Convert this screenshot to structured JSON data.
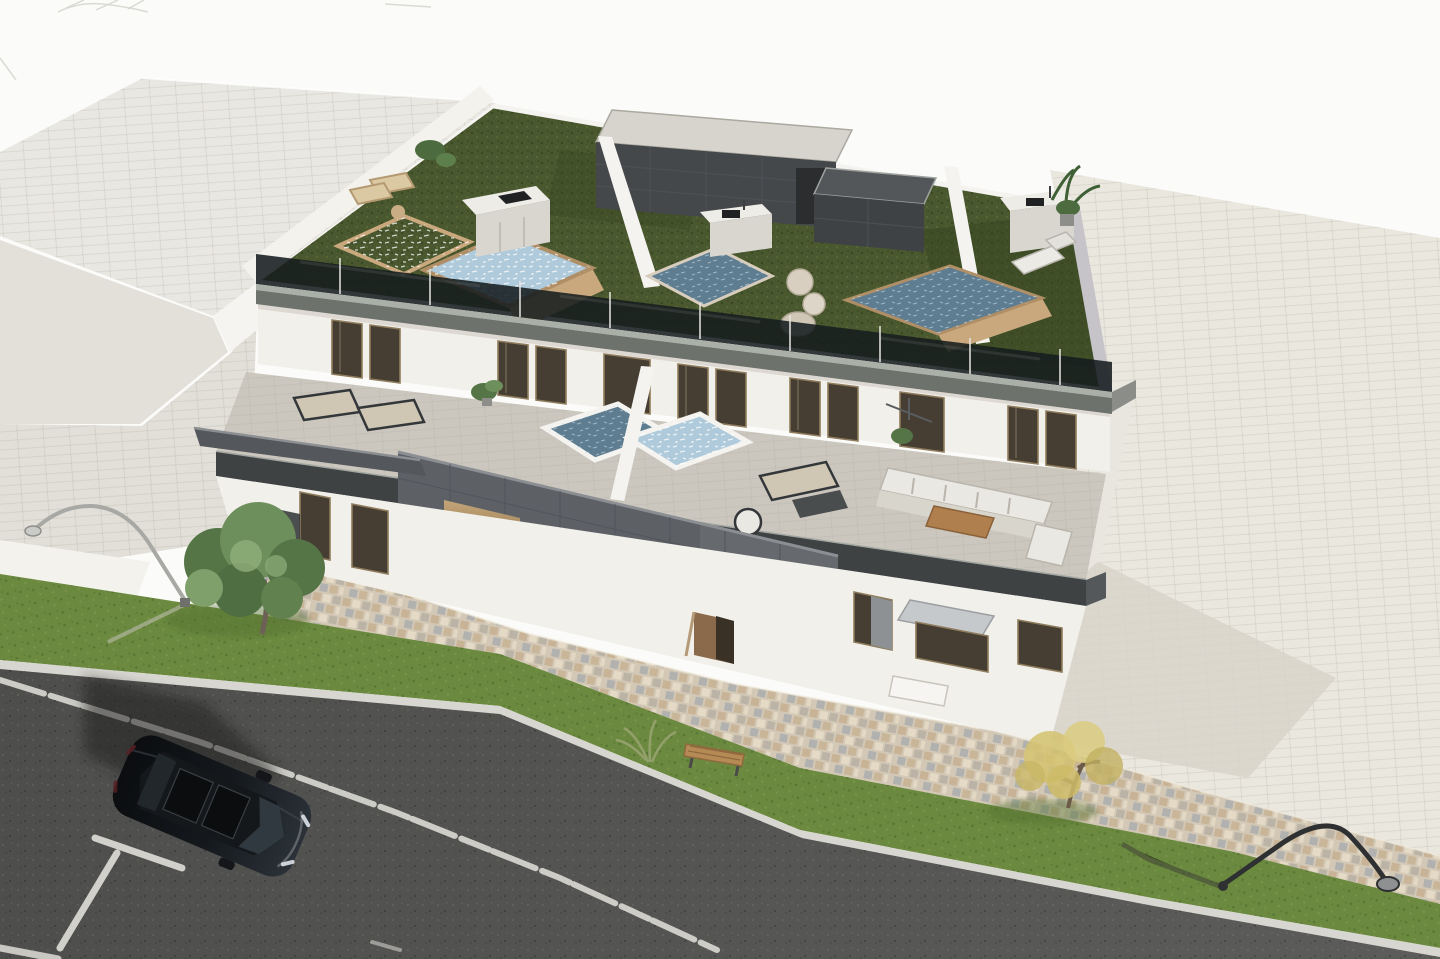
{
  "title": "Aerial 3D architectural rendering of a modern apartment block with rooftop pool terraces, street, parked car and landscaping",
  "palette": {
    "background": "#fbfbf9",
    "neighborRoof": "#e9e7e1",
    "neighborWall": "#f5f4f0",
    "neighborLower": "#e3e0da",
    "sidewalk": "#e2dfd8",
    "driveway": "#f3f2ed",
    "pavement": "#eae7df",
    "pavementShadow": "#d8d4ca",
    "cobble": "#d3c8b6",
    "cobbleTan": "#c5ae8e",
    "cobbleGrey": "#b4aea3",
    "cobbleBlue": "#9fa6ab",
    "cobbleCream": "#e7dcc7",
    "lawn": "#6b8a3f",
    "lawnDark": "#546f31",
    "curb": "#d8d6d0",
    "road": "#4e4e4c",
    "roadLight": "#5c5c5a",
    "marking": "#e8e6e0",
    "turf": "#49582e",
    "turfDark": "#36441f",
    "turfLight": "#5c6c3a",
    "facade": "#f2f0eb",
    "facadeShade": "#ddd9d2",
    "roofFascia": "#6e726c",
    "fasciaLight": "#aab0a7",
    "glassDark": "#161d1f",
    "poolLight": "#aecadb",
    "poolDark": "#5f7d90",
    "wood": "#c9a87e",
    "woodDark": "#b08f66",
    "kitchen": "#eeece7",
    "kitchenFront": "#d9d6d0",
    "bulkTop": "#d6d4cd",
    "bulkDark": "#45484a",
    "panel": "#5d6065",
    "panelLight": "#6d7075",
    "panelLine": "#4b4e53",
    "windowGlass": "#463e33",
    "windowFrame": "#8f7c5c",
    "warm": "#b3946a",
    "warmDark": "#6e5636",
    "doorBrown": "#8a6a4b",
    "terraceFloor": "#cbc7be",
    "terraceFascia": "#3f4243",
    "white": "#f6f5f2",
    "sofa": "#eae8e2",
    "cushion": "#cfc6b4",
    "frameDark": "#34373a",
    "treeGreen1": "#6d8f5b",
    "treeGreen2": "#557547",
    "treeGreen3": "#7fa06b",
    "treeYellow1": "#d3c26e",
    "treeYellow2": "#c2b060",
    "trunk": "#6d6157",
    "carBody": "#101316",
    "carGlass": "#313b42",
    "lampSilver": "#a8a8a4",
    "lampDark": "#2e3031",
    "lavender": "#c6c3c9",
    "shadow": "#1d1d1b"
  },
  "scene": {
    "objects": [
      "white sky background",
      "adjacent building flat roof",
      "three-storey apartment building",
      "rooftop terrace with artificial turf",
      "glass balustrade along roof edge",
      "four rooftop plunge pools with wooden rims",
      "outdoor kitchen islands",
      "dark stair bulkheads on roof",
      "first-floor terrace with sun loungers",
      "twin terrace plunge pools",
      "white outdoor sofa set with wooden coffee table",
      "anthracite tiled facade volume with lit openings",
      "open wooden entrance door",
      "multicoloured cobblestone walkway",
      "green lawn strips",
      "green tree",
      "yellow autumn tree",
      "wooden bench and ornamental grass",
      "two street lamps",
      "asphalt road with white line markings",
      "parking bay markings",
      "black parked car"
    ]
  }
}
